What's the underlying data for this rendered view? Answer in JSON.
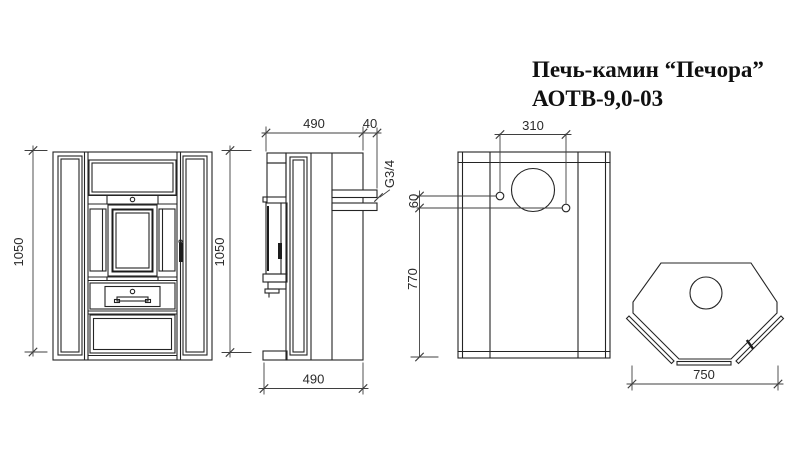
{
  "title": {
    "line1": "Печь-камин “Печора”",
    "line2": "АОТВ-9,0-03"
  },
  "dimensions": {
    "front_height": "1050",
    "side_height": "1050",
    "side_depth_top": "490",
    "side_depth_bottom": "490",
    "rear_stub_length": "40",
    "thread_size": "G3/4",
    "rear_stub_spacing": "310",
    "rear_stub_offset": "60",
    "rear_stub_height": "770",
    "top_width": "750"
  },
  "colors": {
    "background": "#ffffff",
    "line": "#242424",
    "dimension_line": "#3f3f3f",
    "text": "#101010"
  }
}
